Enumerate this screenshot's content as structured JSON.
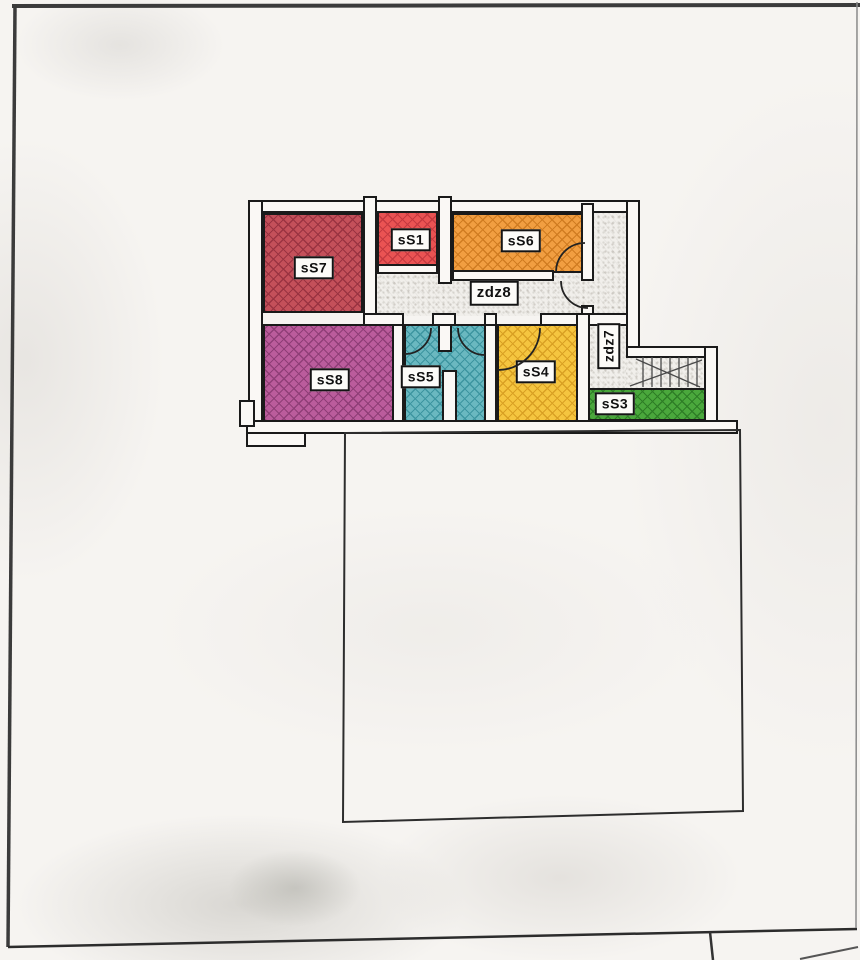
{
  "document_kind": "scanned floor plan drawing",
  "floor_plan": {
    "rooms": [
      {
        "id": "sS7",
        "label": "sS7",
        "color": "#c4505a",
        "hatch": "#9a3341"
      },
      {
        "id": "sS1",
        "label": "sS1",
        "color": "#ea5353",
        "hatch": "#c53a40"
      },
      {
        "id": "sS6",
        "label": "sS6",
        "color": "#f19e41",
        "hatch": "#d07c21"
      },
      {
        "id": "sS8",
        "label": "sS8",
        "color": "#bb5c9c",
        "hatch": "#8f3e77"
      },
      {
        "id": "sS5",
        "label": "sS5",
        "color": "#6ab8c0",
        "hatch": "#3d95a0"
      },
      {
        "id": "sS4",
        "label": "sS4",
        "color": "#f5c53f",
        "hatch": "#d9a023"
      },
      {
        "id": "sS3",
        "label": "sS3",
        "color": "#4aa83c",
        "hatch": "#2e7d26"
      }
    ],
    "corridors": [
      {
        "id": "zdz8",
        "label": "zdz8"
      },
      {
        "id": "zdz7",
        "label": "zdz7"
      }
    ],
    "features": {
      "stairs": "staircase with treads and diagonal run lines",
      "lower_outline": "empty rectangular outline below plan"
    },
    "colors": {
      "wall_fill": "#faf8f5",
      "wall_line": "#1a1a1a",
      "corridor_fill": "#f1efeb",
      "paper": "#f6f4f1",
      "frame": "#3b3b3b"
    }
  }
}
